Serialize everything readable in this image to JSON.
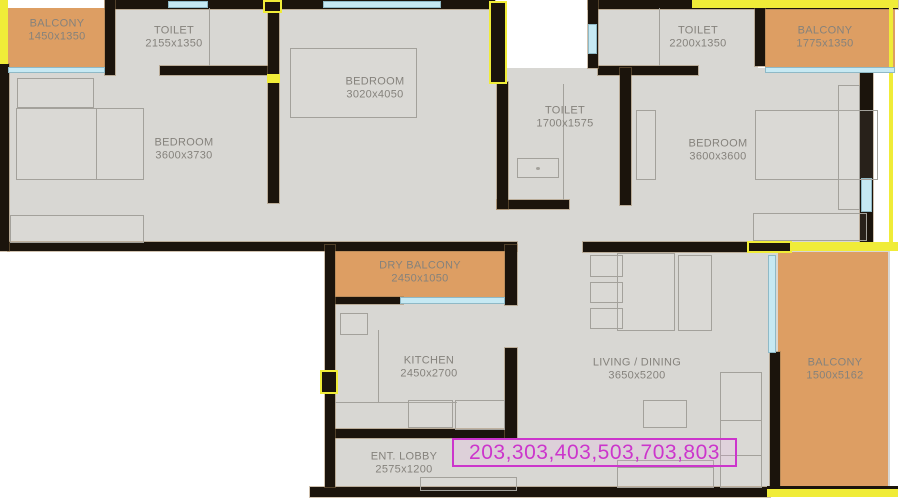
{
  "plan_type": "apartment-floor-plan",
  "unit_label": "203,303,403,503,703,803",
  "rooms": [
    {
      "id": "balcony-top-left",
      "name": "BALCONY",
      "dims": "1450x1350"
    },
    {
      "id": "toilet-top-left",
      "name": "TOILET",
      "dims": "2155x1350"
    },
    {
      "id": "bedroom-top",
      "name": "BEDROOM",
      "dims": "3020x4050"
    },
    {
      "id": "bedroom-left",
      "name": "BEDROOM",
      "dims": "3600x3730"
    },
    {
      "id": "toilet-middle",
      "name": "TOILET",
      "dims": "1700x1575"
    },
    {
      "id": "toilet-top-right",
      "name": "TOILET",
      "dims": "2200x1350"
    },
    {
      "id": "balcony-top-right",
      "name": "BALCONY",
      "dims": "1775x1350"
    },
    {
      "id": "bedroom-right",
      "name": "BEDROOM",
      "dims": "3600x3600"
    },
    {
      "id": "dry-balcony",
      "name": "DRY BALCONY",
      "dims": "2450x1050"
    },
    {
      "id": "kitchen",
      "name": "KITCHEN",
      "dims": "2450x2700"
    },
    {
      "id": "living-dining",
      "name": "LIVING / DINING",
      "dims": "3650x5200"
    },
    {
      "id": "balcony-right",
      "name": "BALCONY",
      "dims": "1500x5162"
    },
    {
      "id": "entrance-lobby",
      "name": "ENT. LOBBY",
      "dims": "2575x1200"
    }
  ],
  "colors": {
    "wall": "#1b140c",
    "floor": "#d8d7d3",
    "balcony_floor": "#dd9e63",
    "window": "#c6e9f3",
    "column_highlight": "#f0ec38",
    "furniture_line": "#a3a19b",
    "label_text": "#85827c",
    "unit_highlight": "#cc35cc",
    "background": "#ffffff"
  }
}
